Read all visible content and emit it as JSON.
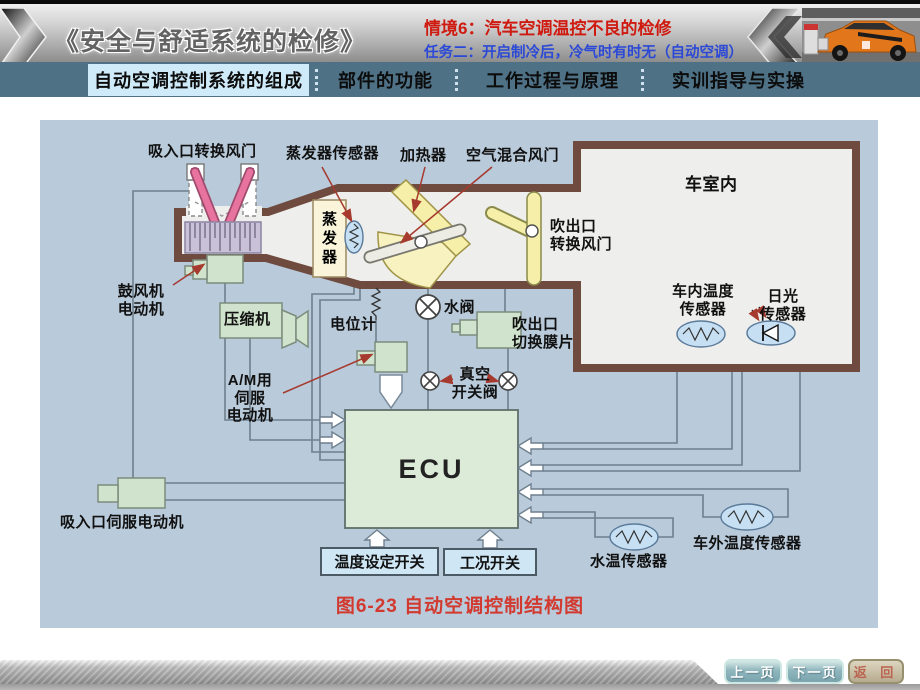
{
  "header": {
    "title": "《安全与舒适系统的检修》",
    "situation": "情境6：汽车空调温控不良的检修",
    "task": "任务二：开启制冷后，冷气时有时无（自动空调）"
  },
  "tabs": [
    {
      "label": "自动空调控制系统的组成",
      "active": true
    },
    {
      "label": "部件的功能",
      "active": false
    },
    {
      "label": "工作过程与原理",
      "active": false
    },
    {
      "label": "实训指导与实操",
      "active": false
    }
  ],
  "diagram": {
    "labels": {
      "intake_damper": "吸入口转换风门",
      "evaporator_sensor": "蒸发器传感器",
      "heater": "加热器",
      "air_mix_damper": "空气混合风门",
      "cabin": "车室内",
      "blower_motor": "鼓风机\n电动机",
      "compressor": "压缩机",
      "potentiometer": "电位计",
      "evaporator": "蒸\n发\n器",
      "am_servo": "A/M用\n伺服\n电动机",
      "water_valve": "水阀",
      "vacuum_valve": "真空\n开关阀",
      "outlet_diaphragm": "吹出口\n切换膜片",
      "outlet_damper": "吹出口\n转换风门",
      "cabin_temp_sensor": "车内温度\n传感器",
      "sun_sensor": "日光\n传感器",
      "ecu": "ECU",
      "intake_servo": "吸入口伺服电动机",
      "temp_set_switch": "温度设定开关",
      "mode_switch": "工况开关",
      "water_temp_sensor": "水温传感器",
      "outside_temp_sensor": "车外温度传感器"
    },
    "caption": "图6-23 自动空调控制结构图"
  },
  "footer": {
    "prev": "上一页",
    "next": "下一页",
    "back": "返 回"
  },
  "colors": {
    "tabbar_bg": "#4e7186",
    "active_tab_bg": "#cfeaf8",
    "diagram_bg": "#b9cada",
    "duct_wall": "#6f4a3e",
    "ecu_fill": "#dcead8",
    "green_box": "#d0e3cc",
    "sensor_blue": "#c6dff2",
    "heater_yellow": "#f5efa9",
    "damper_pink": "#e8739f",
    "caption_red": "#d23a30",
    "situation_red": "#cf1a10",
    "task_blue": "#2b49d6"
  }
}
